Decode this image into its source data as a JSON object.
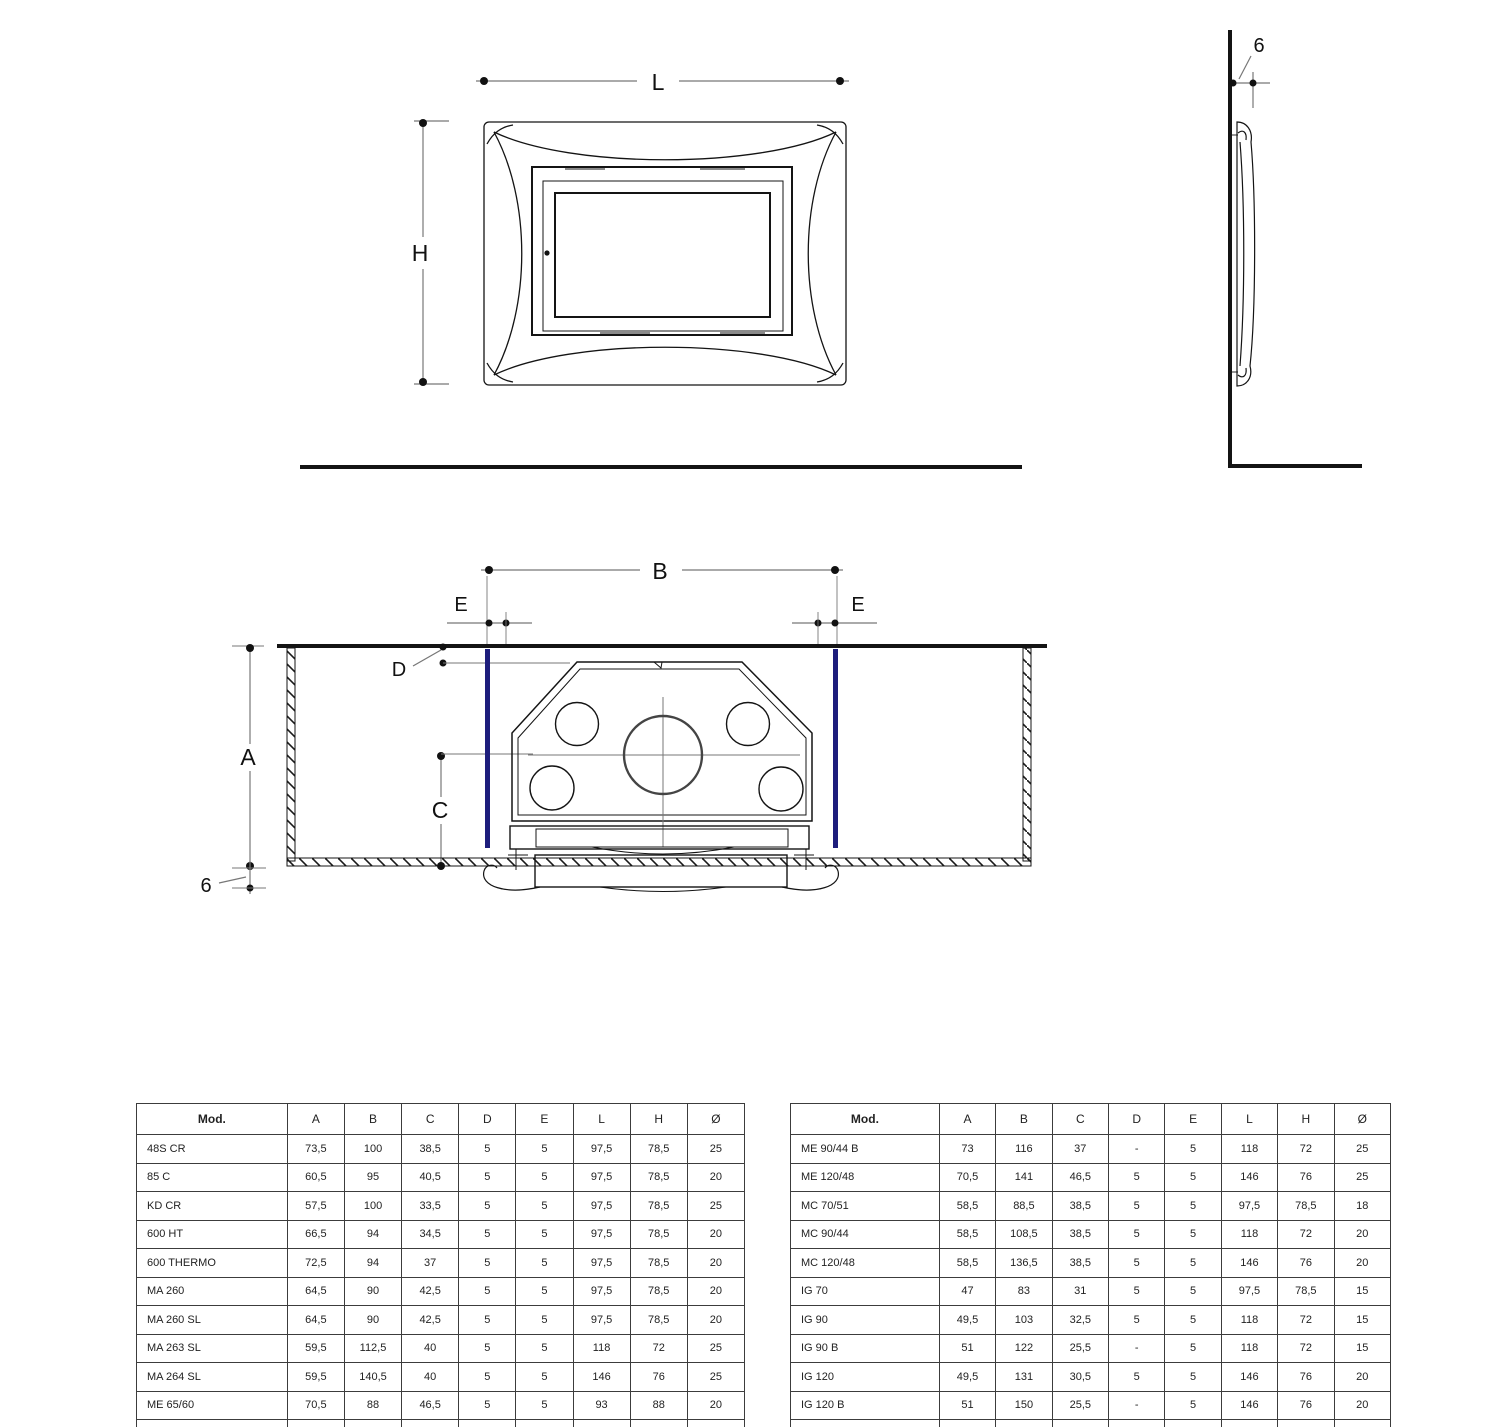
{
  "diagrams": {
    "front_view": {
      "width_label": "L",
      "height_label": "H"
    },
    "side_view": {
      "frame_thickness_label": "6"
    },
    "section_view": {
      "recess_width_label": "B",
      "side_clearance_label_left": "E",
      "side_clearance_label_right": "E",
      "front_gap_label": "D",
      "recess_depth_label": "A",
      "flue_center_label": "C",
      "countertop_thickness_label": "6"
    }
  },
  "tables": {
    "left": {
      "headers": [
        "Mod.",
        "A",
        "B",
        "C",
        "D",
        "E",
        "L",
        "H",
        "Ø"
      ],
      "rows": [
        [
          "48S CR",
          "73,5",
          "100",
          "38,5",
          "5",
          "5",
          "97,5",
          "78,5",
          "25"
        ],
        [
          "85 C",
          "60,5",
          "95",
          "40,5",
          "5",
          "5",
          "97,5",
          "78,5",
          "20"
        ],
        [
          "KD CR",
          "57,5",
          "100",
          "33,5",
          "5",
          "5",
          "97,5",
          "78,5",
          "25"
        ],
        [
          "600 HT",
          "66,5",
          "94",
          "34,5",
          "5",
          "5",
          "97,5",
          "78,5",
          "20"
        ],
        [
          "600 THERMO",
          "72,5",
          "94",
          "37",
          "5",
          "5",
          "97,5",
          "78,5",
          "20"
        ],
        [
          "MA 260",
          "64,5",
          "90",
          "42,5",
          "5",
          "5",
          "97,5",
          "78,5",
          "20"
        ],
        [
          "MA 260 SL",
          "64,5",
          "90",
          "42,5",
          "5",
          "5",
          "97,5",
          "78,5",
          "20"
        ],
        [
          "MA 263 SL",
          "59,5",
          "112,5",
          "40",
          "5",
          "5",
          "118",
          "72",
          "25"
        ],
        [
          "MA 264 SL",
          "59,5",
          "140,5",
          "40",
          "5",
          "5",
          "146",
          "76",
          "25"
        ],
        [
          "ME 65/60",
          "70,5",
          "88",
          "46,5",
          "5",
          "5",
          "93",
          "88",
          "20"
        ],
        [
          "ME 70/51",
          "70,5",
          "92",
          "46,5",
          "5",
          "5",
          "97,5",
          "78,5",
          "20"
        ]
      ]
    },
    "right": {
      "headers": [
        "Mod.",
        "A",
        "B",
        "C",
        "D",
        "E",
        "L",
        "H",
        "Ø"
      ],
      "rows": [
        [
          "ME 90/44 B",
          "73",
          "116",
          "37",
          "-",
          "5",
          "118",
          "72",
          "25"
        ],
        [
          "ME 120/48",
          "70,5",
          "141",
          "46,5",
          "5",
          "5",
          "146",
          "76",
          "25"
        ],
        [
          "MC 70/51",
          "58,5",
          "88,5",
          "38,5",
          "5",
          "5",
          "97,5",
          "78,5",
          "18"
        ],
        [
          "MC 90/44",
          "58,5",
          "108,5",
          "38,5",
          "5",
          "5",
          "118",
          "72",
          "20"
        ],
        [
          "MC 120/48",
          "58,5",
          "136,5",
          "38,5",
          "5",
          "5",
          "146",
          "76",
          "20"
        ],
        [
          "IG 70",
          "47",
          "83",
          "31",
          "5",
          "5",
          "97,5",
          "78,5",
          "15"
        ],
        [
          "IG 90",
          "49,5",
          "103",
          "32,5",
          "5",
          "5",
          "118",
          "72",
          "15"
        ],
        [
          "IG 90 B",
          "51",
          "122",
          "25,5",
          "-",
          "5",
          "118",
          "72",
          "15"
        ],
        [
          "IG 120",
          "49,5",
          "131",
          "30,5",
          "5",
          "5",
          "146",
          "76",
          "20"
        ],
        [
          "IG 120 B",
          "51",
          "150",
          "25,5",
          "-",
          "5",
          "146",
          "76",
          "20"
        ],
        [
          "MP 973",
          "65 / 79 *",
          "104",
          "54 / 69 *",
          "5",
          "5",
          "93",
          "88",
          "8"
        ]
      ]
    }
  },
  "colors": {
    "accent_navy": "#1d1d7c",
    "line": "#141414",
    "dim_line": "#808080"
  }
}
